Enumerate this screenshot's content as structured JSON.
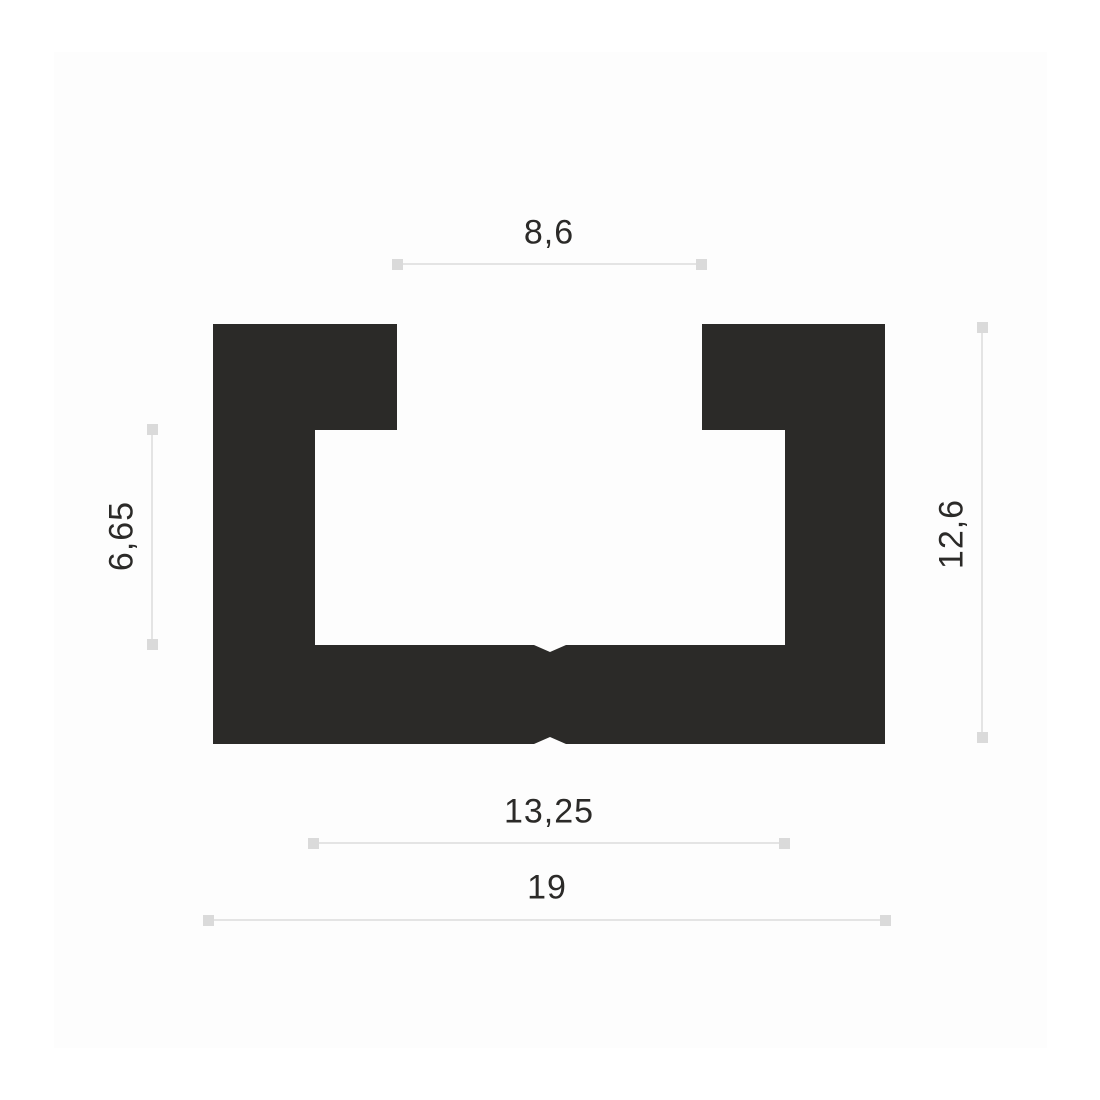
{
  "colors": {
    "background": "#ffffff",
    "card": "#fdfdfd",
    "shape": "#2b2a28",
    "dimension_line": "#e4e4e4",
    "dimension_endpoint": "#dadada",
    "text": "#2b2a28"
  },
  "diagram": {
    "type": "technical-dimension-drawing",
    "subject": "c-channel-profile-cross-section",
    "dimensions": {
      "top_opening_width": {
        "label": "8,6",
        "value": 8.6,
        "orientation": "horizontal",
        "position": "top"
      },
      "cavity_height": {
        "label": "6,65",
        "value": 6.65,
        "orientation": "vertical",
        "position": "left"
      },
      "total_height": {
        "label": "12,6",
        "value": 12.6,
        "orientation": "vertical",
        "position": "right"
      },
      "cavity_width": {
        "label": "13,25",
        "value": 13.25,
        "orientation": "horizontal",
        "position": "bottom"
      },
      "total_width": {
        "label": "19",
        "value": 19,
        "orientation": "horizontal",
        "position": "bottom"
      }
    }
  }
}
